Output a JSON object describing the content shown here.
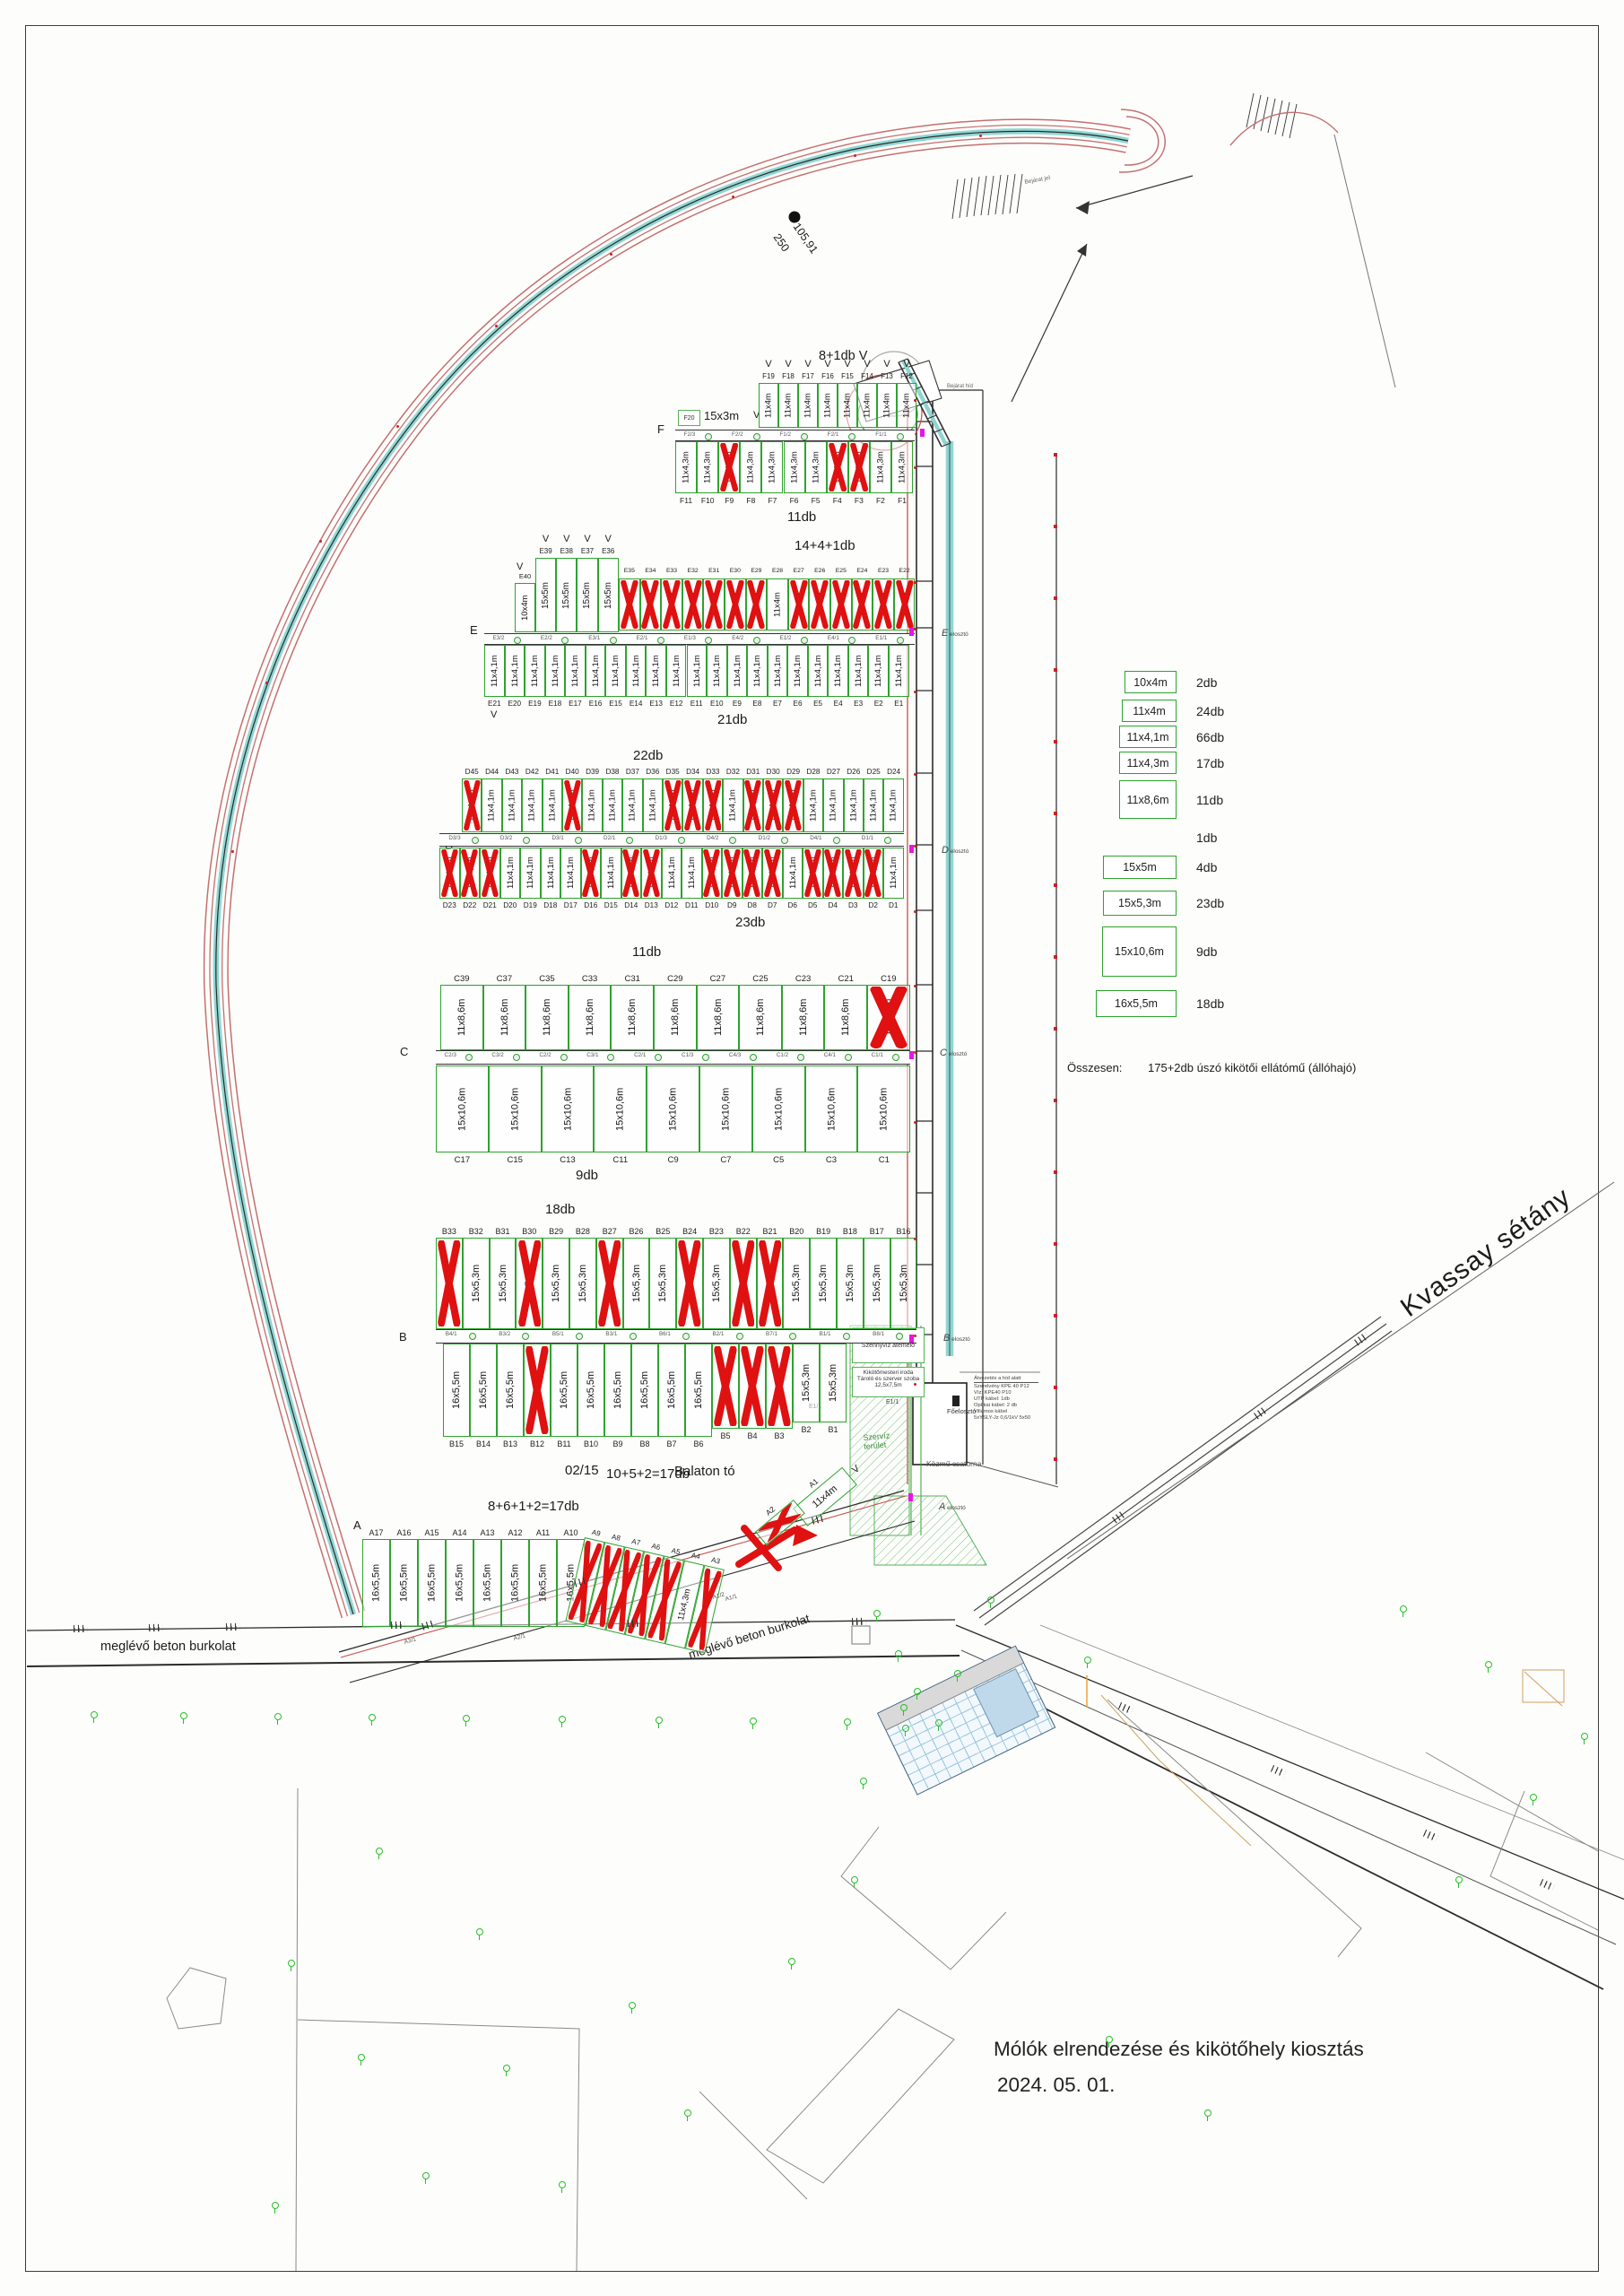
{
  "drawing": {
    "title_line1": "Mólók elrendezése és kikötőhely kiosztás",
    "title_line2": "2024. 05. 01.",
    "arc_len": "105,91",
    "arc_rad": "250",
    "bejarat_jel": "Bejárat jel",
    "bejarat_hid": "Bejárat híd",
    "kvassay": "Kvassay sétány",
    "beton": "meglévő beton burkolat",
    "parcel": "02/15",
    "lake": "Balaton tó",
    "v_mark": "V",
    "f20_id": "F20",
    "f20_size": "15x3m",
    "szerviz1": "Szervíz",
    "szerviz2": "terület",
    "kozmu": "Közmű csatorna",
    "foeloszto": "Főelosztó",
    "e11": "E1/1"
  },
  "row_letters": {
    "f": "F",
    "e": "E",
    "d": "D",
    "c": "C",
    "b": "B",
    "a": "A"
  },
  "counts": {
    "f_top": "8+1db V",
    "f_bot": "11db",
    "e_top": "14+4+1db",
    "e_bot": "21db",
    "d_top": "22db",
    "d_bot": "23db",
    "c_top": "11db",
    "c_bot": "9db",
    "b_top": "18db",
    "b_bot": "10+5+2=17db",
    "a": "8+6+1+2=17db"
  },
  "vizes_lines": [
    "12,5x7,5m",
    "Vizesblokk",
    "Szennyvíz átemelő"
  ],
  "office_lines": [
    "Kikötőmesteri iroda",
    "Tároló és szerver szoba",
    "12,5x7,5m"
  ],
  "notes": [
    "Átvezetés a híd alatt",
    "Szerelvény KPE 40 P12",
    "Víz: KPE40 P10",
    "UTP kábel: 1db",
    "Optikai kábel: 2 db",
    "Villamos kábel",
    "5xYSLY-Jz 0,6/1kV 5x50"
  ],
  "distributors": {
    "word": "elosztó",
    "letters": [
      "E",
      "D",
      "C",
      "B",
      "A"
    ]
  },
  "a_walkway": [
    "A3/1",
    "A2/1",
    "A1/2",
    "A1/1"
  ],
  "walkways": {
    "f": [
      "F2/3",
      "F2/2",
      "F1/2",
      "F2/1",
      "F1/1"
    ],
    "e": [
      "E3/2",
      "E2/2",
      "E3/1",
      "E2/1",
      "E1/3",
      "E4/2",
      "E1/2",
      "E4/1",
      "E1/1"
    ],
    "d": [
      "D3/3",
      "D3/2",
      "D3/1",
      "D2/1",
      "D1/3",
      "D4/2",
      "D1/2",
      "D4/1",
      "D1/1"
    ],
    "c": [
      "C2/3",
      "C3/2",
      "C2/2",
      "C3/1",
      "C2/1",
      "C1/3",
      "C4/3",
      "C1/2",
      "C4/1",
      "C1/1"
    ],
    "b": [
      "B4/1",
      "B3/2",
      "B5/1",
      "B3/1",
      "B6/1",
      "B2/1",
      "B7/1",
      "B1/1",
      "B8/1"
    ]
  },
  "legend": {
    "items": [
      {
        "size": "10x4m",
        "count": "2db"
      },
      {
        "size": "11x4m",
        "count": "24db"
      },
      {
        "size": "11x4,1m",
        "count": "66db"
      },
      {
        "size": "11x4,3m",
        "count": "17db"
      },
      {
        "size": "11x8,6m",
        "count": "11db"
      },
      {
        "size": "",
        "count": "1db"
      },
      {
        "size": "15x5m",
        "count": "4db"
      },
      {
        "size": "15x5,3m",
        "count": "23db"
      },
      {
        "size": "15x10,6m",
        "count": "9db"
      },
      {
        "size": "16x5,5m",
        "count": "18db"
      }
    ],
    "total_label": "Összesen:",
    "total_value": "175+2db úszó kikötői ellátómű (állóhajó)"
  },
  "groups": [
    {
      "key": "F_TOP",
      "berths": [
        {
          "id": "F19",
          "s": "11x4m",
          "v": 1
        },
        {
          "id": "F18",
          "s": "11x4m",
          "v": 1
        },
        {
          "id": "F17",
          "s": "11x4m",
          "v": 1
        },
        {
          "id": "F16",
          "s": "11x4m",
          "v": 1
        },
        {
          "id": "F15",
          "s": "11x4m",
          "v": 1
        },
        {
          "id": "F14",
          "s": "11x4m",
          "v": 1
        },
        {
          "id": "F13",
          "s": "11x4m",
          "v": 1
        },
        {
          "id": "F12",
          "s": "11x4m",
          "v": 1
        }
      ]
    },
    {
      "key": "F_BOT",
      "berths": [
        {
          "id": "F11",
          "s": "11x4,3m"
        },
        {
          "id": "F10",
          "s": "11x4,3m"
        },
        {
          "id": "F9",
          "s": "11x4,3m",
          "x": 1
        },
        {
          "id": "F8",
          "s": "11x4,3m"
        },
        {
          "id": "F7",
          "s": "11x4,3m"
        },
        {
          "id": "F6",
          "s": "11x4,3m"
        },
        {
          "id": "F5",
          "s": "11x4,3m"
        },
        {
          "id": "F4",
          "s": "11x4,3m",
          "x": 1
        },
        {
          "id": "F3",
          "s": "11x4,3m",
          "x": 1
        },
        {
          "id": "F2",
          "s": "11x4,3m"
        },
        {
          "id": "F1",
          "s": "11x4,3m"
        }
      ]
    },
    {
      "key": "E_E40",
      "berths": [
        {
          "id": "E40",
          "s": "10x4m"
        }
      ]
    },
    {
      "key": "E_15X5",
      "berths": [
        {
          "id": "E39",
          "s": "15x5m",
          "v": 1
        },
        {
          "id": "E38",
          "s": "15x5m",
          "v": 1
        },
        {
          "id": "E37",
          "s": "15x5m",
          "v": 1
        },
        {
          "id": "E36",
          "s": "15x5m",
          "v": 1
        }
      ]
    },
    {
      "key": "E_TOPR",
      "berths": [
        {
          "id": "E35",
          "s": "11x4m",
          "x": 1
        },
        {
          "id": "E34",
          "s": "11x4m",
          "x": 1
        },
        {
          "id": "E33",
          "s": "11x4m",
          "x": 1
        },
        {
          "id": "E32",
          "s": "11x4m",
          "x": 1
        },
        {
          "id": "E31",
          "s": "11x4m",
          "x": 1
        },
        {
          "id": "E30",
          "s": "11x4m",
          "x": 1
        },
        {
          "id": "E29",
          "s": "11x4m",
          "x": 1
        },
        {
          "id": "E28",
          "s": "11x4m"
        },
        {
          "id": "E27",
          "s": "11x4m",
          "x": 1
        },
        {
          "id": "E26",
          "s": "11x4m",
          "x": 1
        },
        {
          "id": "E25",
          "s": "11x4m",
          "x": 1
        },
        {
          "id": "E24",
          "s": "11x4m",
          "x": 1
        },
        {
          "id": "E23",
          "s": "11x4m",
          "x": 1
        },
        {
          "id": "E22",
          "s": "11x4m",
          "x": 1
        }
      ]
    },
    {
      "key": "E_BOT",
      "berths": [
        {
          "id": "E21",
          "s": "11x4,1m"
        },
        {
          "id": "E20",
          "s": "11x4,1m"
        },
        {
          "id": "E19",
          "s": "11x4,1m"
        },
        {
          "id": "E18",
          "s": "11x4,1m"
        },
        {
          "id": "E17",
          "s": "11x4,1m"
        },
        {
          "id": "E16",
          "s": "11x4,1m"
        },
        {
          "id": "E15",
          "s": "11x4,1m"
        },
        {
          "id": "E14",
          "s": "11x4,1m"
        },
        {
          "id": "E13",
          "s": "11x4,1m"
        },
        {
          "id": "E12",
          "s": "11x4,1m"
        },
        {
          "id": "E11",
          "s": "11x4,1m"
        },
        {
          "id": "E10",
          "s": "11x4,1m"
        },
        {
          "id": "E9",
          "s": "11x4,1m"
        },
        {
          "id": "E8",
          "s": "11x4,1m"
        },
        {
          "id": "E7",
          "s": "11x4,1m"
        },
        {
          "id": "E6",
          "s": "11x4,1m"
        },
        {
          "id": "E5",
          "s": "11x4,1m"
        },
        {
          "id": "E4",
          "s": "11x4,1m"
        },
        {
          "id": "E3",
          "s": "11x4,1m"
        },
        {
          "id": "E2",
          "s": "11x4,1m"
        },
        {
          "id": "E1",
          "s": "11x4,1m"
        }
      ]
    },
    {
      "key": "D_TOP",
      "berths": [
        {
          "id": "D45",
          "s": "11x4,1m",
          "x": 1
        },
        {
          "id": "D44",
          "s": "11x4,1m"
        },
        {
          "id": "D43",
          "s": "11x4,1m"
        },
        {
          "id": "D42",
          "s": "11x4,1m"
        },
        {
          "id": "D41",
          "s": "11x4,1m"
        },
        {
          "id": "D40",
          "s": "11x4,1m",
          "x": 1
        },
        {
          "id": "D39",
          "s": "11x4,1m"
        },
        {
          "id": "D38",
          "s": "11x4,1m"
        },
        {
          "id": "D37",
          "s": "11x4,1m"
        },
        {
          "id": "D36",
          "s": "11x4,1m"
        },
        {
          "id": "D35",
          "s": "11x4,1m",
          "x": 1
        },
        {
          "id": "D34",
          "s": "11x4,1m",
          "x": 1
        },
        {
          "id": "D33",
          "s": "11x4,1m",
          "x": 1
        },
        {
          "id": "D32",
          "s": "11x4,1m"
        },
        {
          "id": "D31",
          "s": "11x4,1m",
          "x": 1
        },
        {
          "id": "D30",
          "s": "11x4,1m",
          "x": 1
        },
        {
          "id": "D29",
          "s": "11x4,1m",
          "x": 1
        },
        {
          "id": "D28",
          "s": "11x4,1m"
        },
        {
          "id": "D27",
          "s": "11x4,1m"
        },
        {
          "id": "D26",
          "s": "11x4,1m"
        },
        {
          "id": "D25",
          "s": "11x4,1m"
        },
        {
          "id": "D24",
          "s": "11x4,1m"
        }
      ]
    },
    {
      "key": "D_BOT",
      "berths": [
        {
          "id": "D23",
          "s": "11x4,1m",
          "x": 1
        },
        {
          "id": "D22",
          "s": "11x4,1m",
          "x": 1
        },
        {
          "id": "D21",
          "s": "11x4,1m",
          "x": 1
        },
        {
          "id": "D20",
          "s": "11x4,1m"
        },
        {
          "id": "D19",
          "s": "11x4,1m"
        },
        {
          "id": "D18",
          "s": "11x4,1m"
        },
        {
          "id": "D17",
          "s": "11x4,1m"
        },
        {
          "id": "D16",
          "s": "11x4,1m",
          "x": 1
        },
        {
          "id": "D15",
          "s": "11x4,1m"
        },
        {
          "id": "D14",
          "s": "11x4,1m",
          "x": 1
        },
        {
          "id": "D13",
          "s": "11x4,1m",
          "x": 1
        },
        {
          "id": "D12",
          "s": "11x4,1m"
        },
        {
          "id": "D11",
          "s": "11x4,1m"
        },
        {
          "id": "D10",
          "s": "11x4,1m",
          "x": 1
        },
        {
          "id": "D9",
          "s": "11x4,1m",
          "x": 1
        },
        {
          "id": "D8",
          "s": "11x4,1m",
          "x": 1
        },
        {
          "id": "D7",
          "s": "11x4,1m",
          "x": 1
        },
        {
          "id": "D6",
          "s": "11x4,1m"
        },
        {
          "id": "D5",
          "s": "11x4,1m",
          "x": 1
        },
        {
          "id": "D4",
          "s": "11x4,1m",
          "x": 1
        },
        {
          "id": "D3",
          "s": "11x4,1m",
          "x": 1
        },
        {
          "id": "D2",
          "s": "11x4,1m",
          "x": 1
        },
        {
          "id": "D1",
          "s": "11x4,1m"
        }
      ]
    },
    {
      "key": "C_TOP",
      "berths": [
        {
          "id": "C39",
          "s": "11x8,6m"
        },
        {
          "id": "C37",
          "s": "11x8,6m"
        },
        {
          "id": "C35",
          "s": "11x8,6m"
        },
        {
          "id": "C33",
          "s": "11x8,6m"
        },
        {
          "id": "C31",
          "s": "11x8,6m"
        },
        {
          "id": "C29",
          "s": "11x8,6m"
        },
        {
          "id": "C27",
          "s": "11x8,6m"
        },
        {
          "id": "C25",
          "s": "11x8,6m"
        },
        {
          "id": "C23",
          "s": "11x8,6m"
        },
        {
          "id": "C21",
          "s": "11x8,6m"
        },
        {
          "id": "C19",
          "s": "11x8,6m",
          "x": 1
        }
      ]
    },
    {
      "key": "C_BOT",
      "berths": [
        {
          "id": "C17",
          "s": "15x10,6m"
        },
        {
          "id": "C15",
          "s": "15x10,6m"
        },
        {
          "id": "C13",
          "s": "15x10,6m"
        },
        {
          "id": "C11",
          "s": "15x10,6m"
        },
        {
          "id": "C9",
          "s": "15x10,6m"
        },
        {
          "id": "C7",
          "s": "15x10,6m"
        },
        {
          "id": "C5",
          "s": "15x10,6m"
        },
        {
          "id": "C3",
          "s": "15x10,6m"
        },
        {
          "id": "C1",
          "s": "15x10,6m"
        }
      ]
    },
    {
      "key": "B_TOP",
      "berths": [
        {
          "id": "B33",
          "s": "15x5,3m",
          "x": 1
        },
        {
          "id": "B32",
          "s": "15x5,3m"
        },
        {
          "id": "B31",
          "s": "15x5,3m"
        },
        {
          "id": "B30",
          "s": "15x5,3m",
          "x": 1
        },
        {
          "id": "B29",
          "s": "15x5,3m"
        },
        {
          "id": "B28",
          "s": "15x5,3m"
        },
        {
          "id": "B27",
          "s": "15x5,3m",
          "x": 1
        },
        {
          "id": "B26",
          "s": "15x5,3m"
        },
        {
          "id": "B25",
          "s": "15x5,3m"
        },
        {
          "id": "B24",
          "s": "15x5,3m",
          "x": 1
        },
        {
          "id": "B23",
          "s": "15x5,3m"
        },
        {
          "id": "B22",
          "s": "15x5,3m",
          "x": 1
        },
        {
          "id": "B21",
          "s": "15x5,3m",
          "x": 1
        },
        {
          "id": "B20",
          "s": "15x5,3m"
        },
        {
          "id": "B19",
          "s": "15x5,3m"
        },
        {
          "id": "B18",
          "s": "15x5,3m"
        },
        {
          "id": "B17",
          "s": "15x5,3m"
        },
        {
          "id": "B16",
          "s": "15x5,3m"
        }
      ]
    },
    {
      "key": "B_BOT",
      "berths": [
        {
          "id": "B15",
          "s": "16x5,5m"
        },
        {
          "id": "B14",
          "s": "16x5,5m"
        },
        {
          "id": "B13",
          "s": "16x5,5m"
        },
        {
          "id": "B12",
          "s": "16x5,5m",
          "x": 1
        },
        {
          "id": "B11",
          "s": "16x5,5m"
        },
        {
          "id": "B10",
          "s": "16x5,5m"
        },
        {
          "id": "B9",
          "s": "16x5,5m"
        },
        {
          "id": "B8",
          "s": "16x5,5m"
        },
        {
          "id": "B7",
          "s": "16x5,5m"
        },
        {
          "id": "B6",
          "s": "16x5,5m"
        },
        {
          "id": "B5",
          "s": "",
          "x": 1
        },
        {
          "id": "B4",
          "s": "",
          "x": 1
        },
        {
          "id": "B3",
          "s": "",
          "x": 1
        },
        {
          "id": "B2",
          "s": "15x5,3m"
        },
        {
          "id": "B1",
          "s": "15x5,3m"
        }
      ]
    },
    {
      "key": "A_LEFT",
      "berths": [
        {
          "id": "A17",
          "s": "16x5,5m"
        },
        {
          "id": "A16",
          "s": "16x5,5m"
        },
        {
          "id": "A15",
          "s": "16x5,5m"
        },
        {
          "id": "A14",
          "s": "16x5,5m"
        },
        {
          "id": "A13",
          "s": "16x5,5m"
        },
        {
          "id": "A12",
          "s": "16x5,5m"
        },
        {
          "id": "A11",
          "s": "16x5,5m"
        },
        {
          "id": "A10",
          "s": "16x5,5m"
        }
      ]
    },
    {
      "key": "A_MID",
      "berths": [
        {
          "id": "A9",
          "s": "",
          "x": 1
        },
        {
          "id": "A8",
          "s": "",
          "x": 1
        },
        {
          "id": "A7",
          "s": "",
          "x": 1
        },
        {
          "id": "A6",
          "s": "",
          "x": 1
        },
        {
          "id": "A5",
          "s": "",
          "x": 1
        },
        {
          "id": "A4",
          "s": "11x4,3m"
        },
        {
          "id": "A3",
          "s": "",
          "x": 1
        }
      ]
    },
    {
      "key": "A1",
      "berths": [
        {
          "id": "A1",
          "s": "11x4m"
        }
      ]
    },
    {
      "key": "A2",
      "berths": [
        {
          "id": "A2",
          "s": "",
          "x": 1
        }
      ]
    }
  ]
}
